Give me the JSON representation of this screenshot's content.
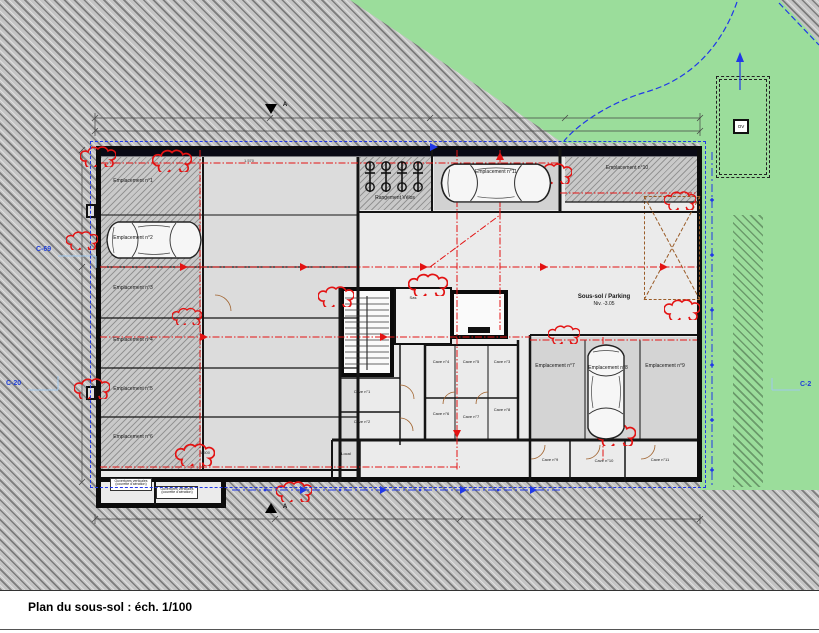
{
  "caption": "Plan du sous-sol : éch. 1/100",
  "boundary_labels": {
    "left_upper": "C-69",
    "left_lower": "C-20",
    "right": "C-2"
  },
  "section_marker": "A",
  "parking_spots": [
    "Emplacement n°1",
    "Emplacement n°2",
    "Emplacement n°3",
    "Emplacement n°4",
    "Emplacement n°5",
    "Emplacement n°6",
    "Emplacement n°7",
    "Emplacement n°8",
    "Emplacement n°9",
    "Emplacement n°10",
    "Emplacement n°11"
  ],
  "caves": [
    "Cave n°1",
    "Cave n°2",
    "Cave n°3",
    "Cave n°4",
    "Cave n°5",
    "Cave n°6",
    "Cave n°7",
    "Cave n°8",
    "Cave n°9",
    "Cave n°10",
    "Cave n°11"
  ],
  "rooms": {
    "bike_storage": "Rangement Vélos",
    "zone": "Sous-sol / Parking",
    "zone_level": "Niv. -3.05",
    "sas": "Sas",
    "local": "Local",
    "courette": "Ouvertures verticales (courette d'aération)",
    "ov_box": "OV"
  },
  "dimensions": [
    "1.570",
    "1.500"
  ],
  "colors": {
    "green": "#9bdd9b",
    "hatch_base": "#c4c4c4",
    "wall": "#101010",
    "red": "#e31313",
    "blue": "#2038e8",
    "ramp_brown": "#9a5c28"
  }
}
